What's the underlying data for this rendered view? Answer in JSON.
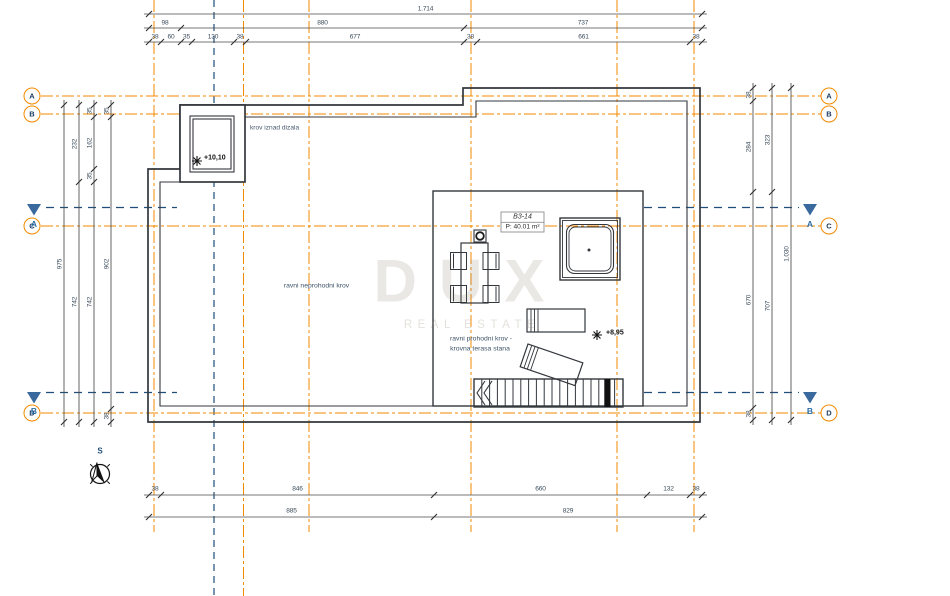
{
  "colors": {
    "grid_orange": "#F18A00",
    "section_blue": "#1F4E79",
    "line_dark": "#33373C"
  },
  "grid": {
    "axes": [
      "A",
      "B",
      "C",
      "D"
    ],
    "sections": [
      "A",
      "B"
    ],
    "north_label": "S"
  },
  "dimensions": {
    "top": {
      "total": "1.714",
      "row2": [
        "98",
        "880",
        "737"
      ],
      "row3": [
        "38",
        "60",
        "35",
        "130",
        "38",
        "677",
        "38",
        "661",
        "38"
      ]
    },
    "bottom": {
      "row1": [
        "38",
        "846",
        "660",
        "132",
        "38"
      ],
      "row2": [
        "885",
        "829"
      ]
    },
    "left": {
      "c1": [
        "975"
      ],
      "c2": [
        "232",
        "742"
      ],
      "c3": [
        "35",
        "162",
        "35",
        "742"
      ],
      "c4": [
        "35",
        "902",
        "38"
      ]
    },
    "right": {
      "c1": [
        "38",
        "284",
        "670",
        "38"
      ],
      "c2": [
        "323",
        "707"
      ],
      "c3": [
        "1.030"
      ]
    }
  },
  "room": {
    "id": "B3-14",
    "area": "P: 40.01 m²"
  },
  "annotations": {
    "roof_over_elevator": "krov iznad dizala",
    "non_walkable_roof": "ravni neprohodni krov",
    "walkable_roof_line1": "ravni prohodni krov -",
    "walkable_roof_line2": "krovna terasa stana",
    "elevation_elevator": "+10,10",
    "elevation_terrace": "+8,95"
  },
  "watermark": {
    "line1": "DUX",
    "line2": "REAL ESTATE"
  }
}
